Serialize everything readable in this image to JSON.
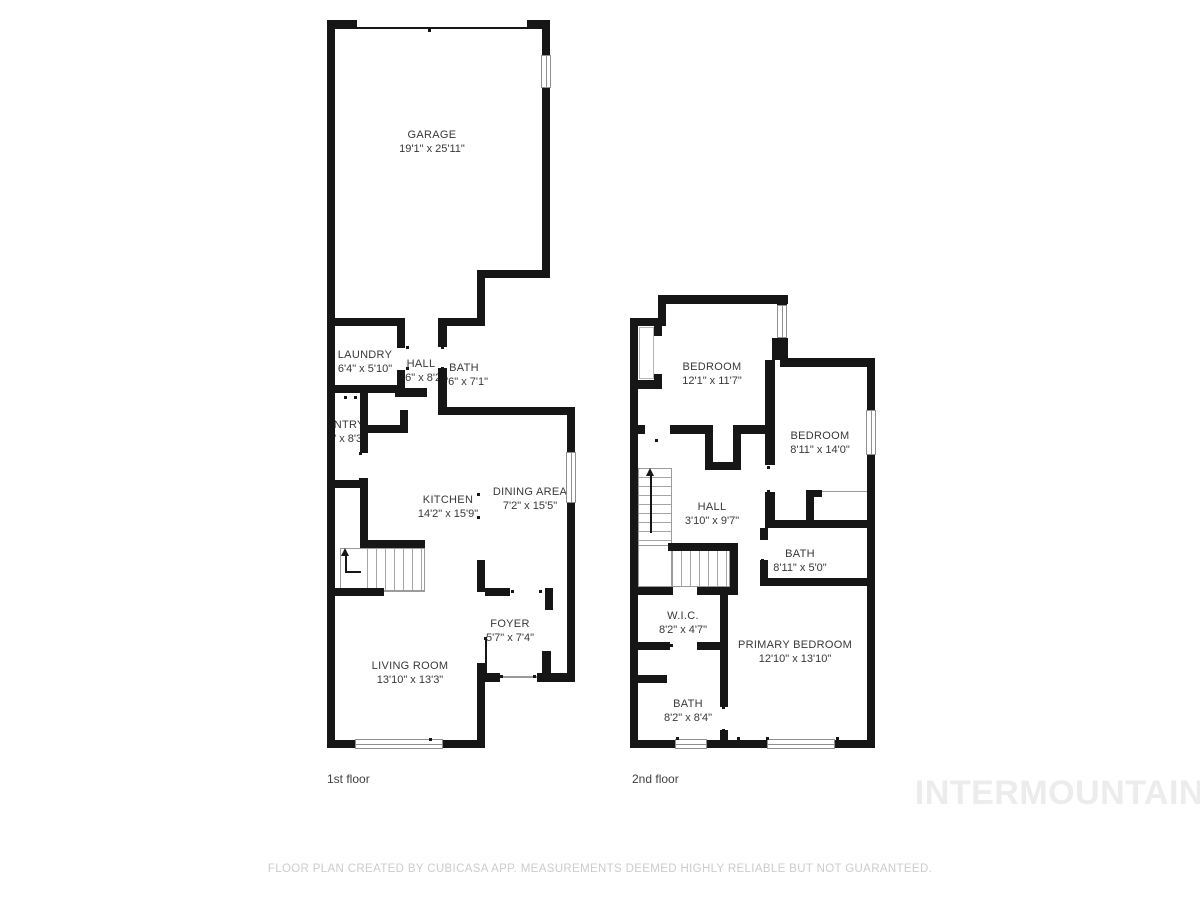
{
  "floors": [
    {
      "label": "1st floor",
      "rooms": [
        {
          "name": "GARAGE",
          "dims": "19'1\" x 25'11\""
        },
        {
          "name": "LAUNDRY",
          "dims": "6'4\" x 5'10\""
        },
        {
          "name": "HALL",
          "dims": "3'6\" x 8'2\""
        },
        {
          "name": "BATH",
          "dims": "2'6\" x 7'1\""
        },
        {
          "name": "PANTRY",
          "dims": "6'4\" x 8'3\""
        },
        {
          "name": "KITCHEN",
          "dims": "14'2\" x 15'9\""
        },
        {
          "name": "DINING AREA",
          "dims": "7'2\" x 15'5\""
        },
        {
          "name": "FOYER",
          "dims": "5'7\" x 7'4\""
        },
        {
          "name": "LIVING ROOM",
          "dims": "13'10\" x 13'3\""
        }
      ]
    },
    {
      "label": "2nd floor",
      "rooms": [
        {
          "name": "BEDROOM",
          "dims": "12'1\" x 11'7\""
        },
        {
          "name": "BEDROOM",
          "dims": "8'11\" x 14'0\""
        },
        {
          "name": "HALL",
          "dims": "3'10\" x 9'7\""
        },
        {
          "name": "BATH",
          "dims": "8'11\" x 5'0\""
        },
        {
          "name": "W.I.C.",
          "dims": "8'2\" x 4'7\""
        },
        {
          "name": "PRIMARY BEDROOM",
          "dims": "12'10\" x 13'10\""
        },
        {
          "name": "BATH",
          "dims": "8'2\" x 8'4\""
        }
      ]
    }
  ],
  "watermark": "INTERMOUNTAIN",
  "disclaimer": "FLOOR PLAN CREATED BY CUBICASA APP. MEASUREMENTS DEEMED HIGHLY RELIABLE BUT NOT GUARANTEED.",
  "colors": {
    "wall": "#161616",
    "room_text": "#383838",
    "floor_label": "#3f3f3f",
    "disclaimer_text": "#cccccc",
    "watermark_text": "#ececec"
  }
}
